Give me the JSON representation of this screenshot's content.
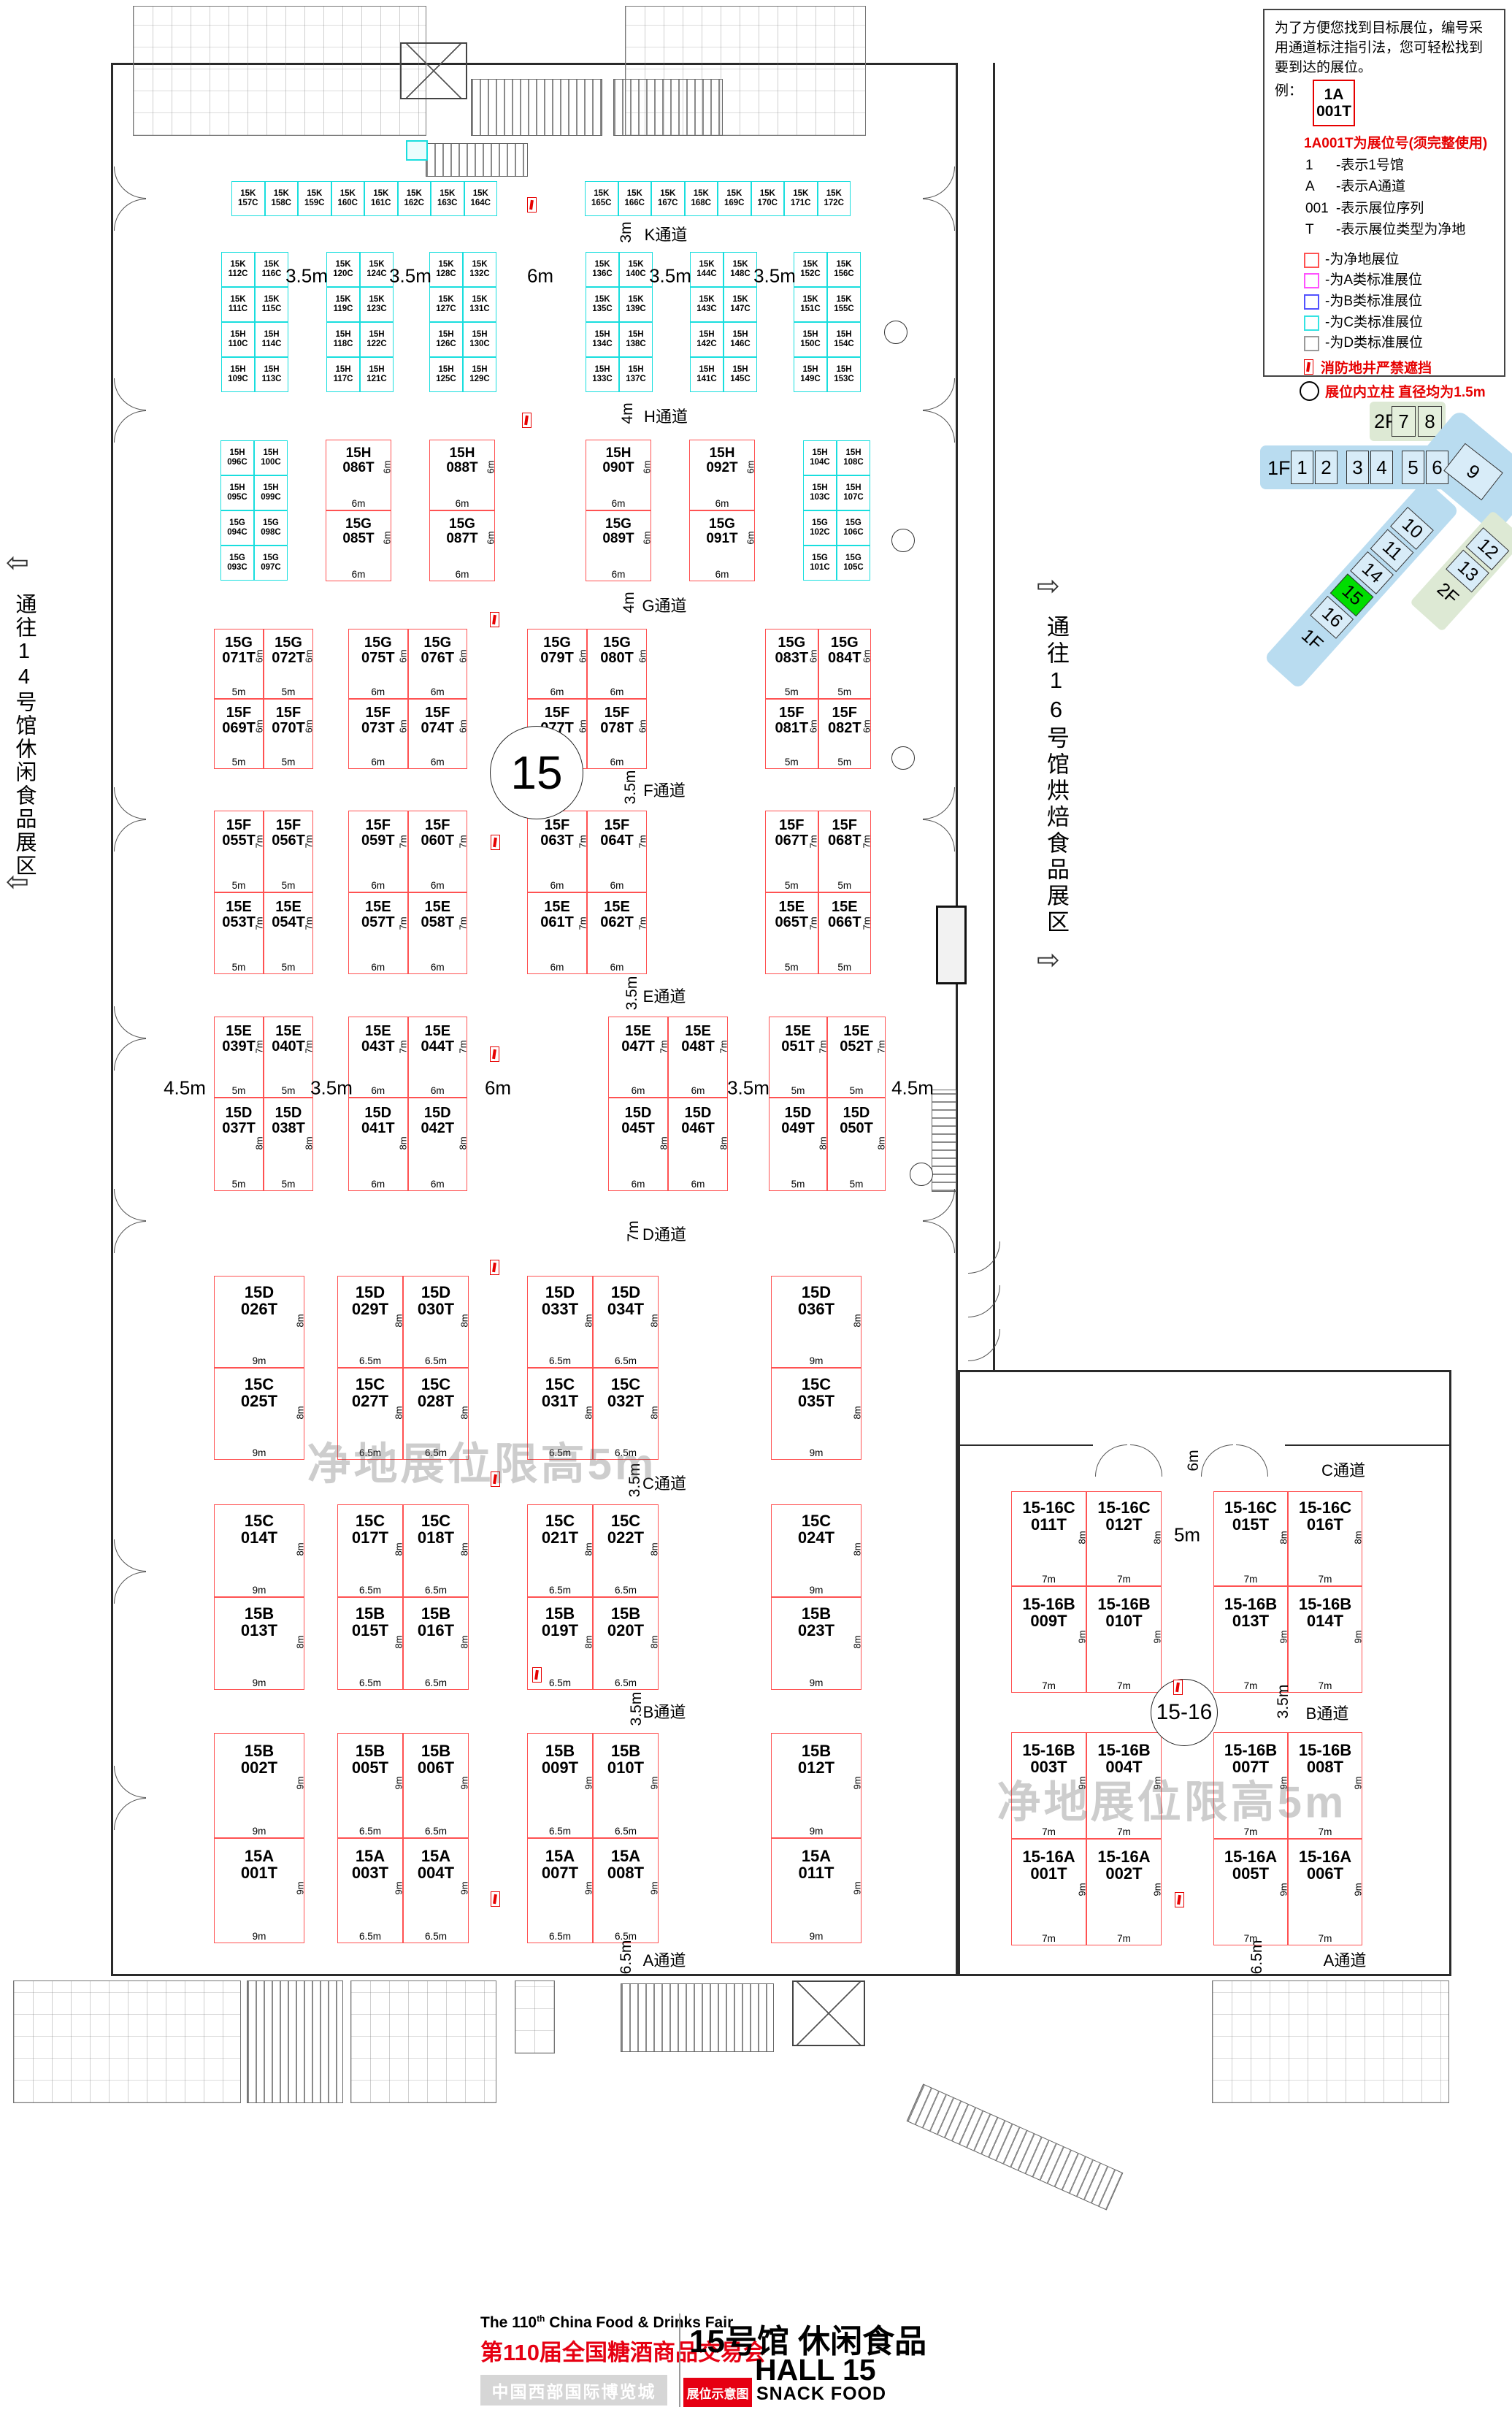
{
  "legend": {
    "intro_lines": [
      "为了方便您找到目标展位，编号采",
      "用通道标注指引法，您可轻松找到",
      "要到达的展位。"
    ],
    "example_label": "例：",
    "example_box": {
      "line1": "1A",
      "line2": "001T"
    },
    "code_note": "1A001T为展位号(须完整使用)",
    "code_items": [
      {
        "code": "1",
        "desc": "-表示1号馆"
      },
      {
        "code": "A",
        "desc": "-表示A通道"
      },
      {
        "code": "001",
        "desc": "-表示展位序列"
      },
      {
        "code": "T",
        "desc": "-表示展位类型为净地"
      }
    ],
    "class_items": [
      {
        "color": "#ff5252",
        "label": "-为净地展位"
      },
      {
        "color": "#ff52ff",
        "label": "-为A类标准展位"
      },
      {
        "color": "#5252ff",
        "label": "-为B类标准展位"
      },
      {
        "color": "#35e3e3",
        "label": "-为C类标准展位"
      },
      {
        "color": "#9a9a9a",
        "label": "-为D类标准展位"
      }
    ],
    "fire_note": "消防地井严禁遮挡",
    "pillar_note": "展位内立柱 直径均为1.5m"
  },
  "navigator": {
    "f2": "2F",
    "f2_halls": [
      "7",
      "8"
    ],
    "f1": "1F",
    "f1_halls": [
      "1",
      "2",
      "3",
      "4",
      "5",
      "6"
    ],
    "hall9": "9",
    "diag_halls": [
      "1F",
      "16",
      "15",
      "14",
      "11",
      "10"
    ],
    "green_halls": [
      "2F",
      "13",
      "12"
    ],
    "current_hall": "15"
  },
  "side_labels": {
    "left": "通往14号馆休闲食品展区",
    "right": "通往16号馆烘焙食品展区"
  },
  "watermark": "净地展位限高5m",
  "circle_labels": {
    "main": "15",
    "wing": "15-16"
  },
  "aisles": {
    "main": [
      {
        "name": "K通道",
        "dim": "3m"
      },
      {
        "name": "H通道",
        "dim": "4m"
      },
      {
        "name": "G通道",
        "dim": "4m"
      },
      {
        "name": "F通道",
        "dim": "3.5m"
      },
      {
        "name": "E通道",
        "dim": "3.5m"
      },
      {
        "name": "D通道",
        "dim": "7m"
      },
      {
        "name": "C通道",
        "dim": "3.5m"
      },
      {
        "name": "B通道",
        "dim": "3.5m"
      },
      {
        "name": "A通道",
        "dim": "6.5m"
      }
    ],
    "wing": [
      {
        "name": "C通道",
        "dim": "6m"
      },
      {
        "name": "B通道",
        "dim": "3.5m"
      },
      {
        "name": "A通道",
        "dim": "6.5m"
      }
    ]
  },
  "gap_labels": {
    "kh": [
      "3.5m",
      "3.5m",
      "6m",
      "3.5m",
      "3.5m"
    ],
    "ed": [
      "4.5m",
      "3.5m",
      "6m",
      "3.5m",
      "4.5m"
    ],
    "rw": [
      "5m"
    ]
  },
  "booths": {
    "k_row": [
      [
        "15K 157C",
        "15K 158C",
        "15K 159C",
        "15K 160C",
        "15K 161C",
        "15K 162C",
        "15K 163C",
        "15K 164C"
      ],
      [
        "15K 165C",
        "15K 166C",
        "15K 167C",
        "15K 168C",
        "15K 169C",
        "15K 170C",
        "15K 171C",
        "15K 172C"
      ]
    ],
    "kh": [
      [
        [
          "15K 112C",
          "15K 116C"
        ],
        [
          "15K 111C",
          "15K 115C"
        ],
        [
          "15H 110C",
          "15H 114C"
        ],
        [
          "15H 109C",
          "15H 113C"
        ]
      ],
      [
        [
          "15K 120C",
          "15K 124C"
        ],
        [
          "15K 119C",
          "15K 123C"
        ],
        [
          "15H 118C",
          "15H 122C"
        ],
        [
          "15H 117C",
          "15H 121C"
        ]
      ],
      [
        [
          "15K 128C",
          "15K 132C"
        ],
        [
          "15K 127C",
          "15K 131C"
        ],
        [
          "15H 126C",
          "15H 130C"
        ],
        [
          "15H 125C",
          "15H 129C"
        ]
      ],
      [
        [
          "15K 136C",
          "15K 140C"
        ],
        [
          "15K 135C",
          "15K 139C"
        ],
        [
          "15H 134C",
          "15H 138C"
        ],
        [
          "15H 133C",
          "15H 137C"
        ]
      ],
      [
        [
          "15K 144C",
          "15K 148C"
        ],
        [
          "15K 143C",
          "15K 147C"
        ],
        [
          "15H 142C",
          "15H 146C"
        ],
        [
          "15H 141C",
          "15H 145C"
        ]
      ],
      [
        [
          "15K 152C",
          "15K 156C"
        ],
        [
          "15K 151C",
          "15K 155C"
        ],
        [
          "15H 150C",
          "15H 154C"
        ],
        [
          "15H 149C",
          "15H 153C"
        ]
      ]
    ],
    "hg_cyan": [
      [
        [
          "15H 096C",
          "15H 100C"
        ],
        [
          "15H 095C",
          "15H 099C"
        ],
        [
          "15G 094C",
          "15G 098C"
        ],
        [
          "15G 093C",
          "15G 097C"
        ]
      ],
      [
        [
          "15H 104C",
          "15H 108C"
        ],
        [
          "15H 103C",
          "15H 107C"
        ],
        [
          "15G 102C",
          "15G 106C"
        ],
        [
          "15G 101C",
          "15G 105C"
        ]
      ]
    ],
    "hg_red": {
      "side": "6m",
      "dim": "6m",
      "pairs": [
        [
          "15H 086T",
          "15G 085T"
        ],
        [
          "15H 088T",
          "15G 087T"
        ],
        [
          "15H 090T",
          "15G 089T"
        ],
        [
          "15H 092T",
          "15G 091T"
        ]
      ]
    },
    "sections": {
      "gf": {
        "sides": [
          "6m",
          "6m"
        ],
        "blocks": [
          {
            "dim": "5m",
            "rows": [
              [
                "15G 071T",
                "15G 072T"
              ],
              [
                "15F 069T",
                "15F 070T"
              ]
            ]
          },
          {
            "dim": "6m",
            "rows": [
              [
                "15G 075T",
                "15G 076T"
              ],
              [
                "15F 073T",
                "15F 074T"
              ]
            ]
          },
          {
            "dim": "6m",
            "rows": [
              [
                "15G 079T",
                "15G 080T"
              ],
              [
                "15F 077T",
                "15F 078T"
              ]
            ]
          },
          {
            "dim": "5m",
            "rows": [
              [
                "15G 083T",
                "15G 084T"
              ],
              [
                "15F 081T",
                "15F 082T"
              ]
            ]
          }
        ]
      },
      "fe": {
        "sides": [
          "7m",
          "7m"
        ],
        "blocks": [
          {
            "dim": "5m",
            "rows": [
              [
                "15F 055T",
                "15F 056T"
              ],
              [
                "15E 053T",
                "15E 054T"
              ]
            ]
          },
          {
            "dim": "6m",
            "rows": [
              [
                "15F 059T",
                "15F 060T"
              ],
              [
                "15E 057T",
                "15E 058T"
              ]
            ]
          },
          {
            "dim": "6m",
            "rows": [
              [
                "15F 063T",
                "15F 064T"
              ],
              [
                "15E 061T",
                "15E 062T"
              ]
            ]
          },
          {
            "dim": "5m",
            "rows": [
              [
                "15F 067T",
                "15F 068T"
              ],
              [
                "15E 065T",
                "15E 066T"
              ]
            ]
          }
        ]
      },
      "ed": {
        "sides": [
          "7m",
          "8m"
        ],
        "blocks": [
          {
            "dim": "5m",
            "rows": [
              [
                "15E 039T",
                "15E 040T"
              ],
              [
                "15D 037T",
                "15D 038T"
              ]
            ]
          },
          {
            "dim": "6m",
            "rows": [
              [
                "15E 043T",
                "15E 044T"
              ],
              [
                "15D 041T",
                "15D 042T"
              ]
            ]
          },
          {
            "dim": "6m",
            "rows": [
              [
                "15E 047T",
                "15E 048T"
              ],
              [
                "15D 045T",
                "15D 046T"
              ]
            ]
          },
          {
            "dim": "5m",
            "rows": [
              [
                "15E 051T",
                "15E 052T"
              ],
              [
                "15D 049T",
                "15D 050T"
              ]
            ]
          }
        ]
      },
      "dc": {
        "sides": [
          "8m",
          "8m"
        ],
        "blocks": [
          {
            "dim": "9m",
            "rows": [
              [
                "15D 026T"
              ],
              [
                "15C 025T"
              ]
            ]
          },
          {
            "dim": "6.5m",
            "rows": [
              [
                "15D 029T",
                "15D 030T"
              ],
              [
                "15C 027T",
                "15C 028T"
              ]
            ]
          },
          {
            "dim": "6.5m",
            "rows": [
              [
                "15D 033T",
                "15D 034T"
              ],
              [
                "15C 031T",
                "15C 032T"
              ]
            ]
          },
          {
            "dim": "9m",
            "rows": [
              [
                "15D 036T"
              ],
              [
                "15C 035T"
              ]
            ]
          }
        ]
      },
      "cb": {
        "sides": [
          "8m",
          "8m"
        ],
        "blocks": [
          {
            "dim": "9m",
            "rows": [
              [
                "15C 014T"
              ],
              [
                "15B 013T"
              ]
            ]
          },
          {
            "dim": "6.5m",
            "rows": [
              [
                "15C 017T",
                "15C 018T"
              ],
              [
                "15B 015T",
                "15B 016T"
              ]
            ]
          },
          {
            "dim": "6.5m",
            "rows": [
              [
                "15C 021T",
                "15C 022T"
              ],
              [
                "15B 019T",
                "15B 020T"
              ]
            ]
          },
          {
            "dim": "9m",
            "rows": [
              [
                "15C 024T"
              ],
              [
                "15B 023T"
              ]
            ]
          }
        ]
      },
      "ba": {
        "sides": [
          "9m",
          "9m"
        ],
        "blocks": [
          {
            "dim": "9m",
            "rows": [
              [
                "15B 002T"
              ],
              [
                "15A 001T"
              ]
            ]
          },
          {
            "dim": "6.5m",
            "rows": [
              [
                "15B 005T",
                "15B 006T"
              ],
              [
                "15A 003T",
                "15A 004T"
              ]
            ]
          },
          {
            "dim": "6.5m",
            "rows": [
              [
                "15B 009T",
                "15B 010T"
              ],
              [
                "15A 007T",
                "15A 008T"
              ]
            ]
          },
          {
            "dim": "9m",
            "rows": [
              [
                "15B 012T"
              ],
              [
                "15A 011T"
              ]
            ]
          }
        ]
      },
      "rw1": {
        "sides": [
          "8m",
          "9m"
        ],
        "blocks": [
          {
            "dim": "7m",
            "rows": [
              [
                "15-16C 011T",
                "15-16C 012T"
              ],
              [
                "15-16B 009T",
                "15-16B 010T"
              ]
            ]
          },
          {
            "dim": "7m",
            "rows": [
              [
                "15-16C 015T",
                "15-16C 016T"
              ],
              [
                "15-16B 013T",
                "15-16B 014T"
              ]
            ]
          }
        ]
      },
      "rw2": {
        "sides": [
          "9m",
          "9m"
        ],
        "blocks": [
          {
            "dim": "7m",
            "rows": [
              [
                "15-16B 003T",
                "15-16B 004T"
              ],
              [
                "15-16A 001T",
                "15-16A 002T"
              ]
            ]
          },
          {
            "dim": "7m",
            "rows": [
              [
                "15-16B 007T",
                "15-16B 008T"
              ],
              [
                "15-16A 005T",
                "15-16A 006T"
              ]
            ]
          }
        ]
      }
    }
  },
  "footer": {
    "en_title_pre": "The 110",
    "en_title_sup": "th",
    "en_title_post": " China Food & Drinks Fair",
    "cn_title": "第110届全国糖酒商品交易会",
    "venue": "中国西部国际博览城",
    "hall_title_cn": "15号馆 休闲食品",
    "hall_title_en": "HALL 15",
    "map_tag": "展位示意图",
    "hall_subtitle_en": "SNACK FOOD"
  },
  "colors": {
    "booth_clear_border": "#ff5252",
    "booth_c_border": "#19dede",
    "red_text": "#e60012",
    "highlight_green": "#00dd00"
  }
}
